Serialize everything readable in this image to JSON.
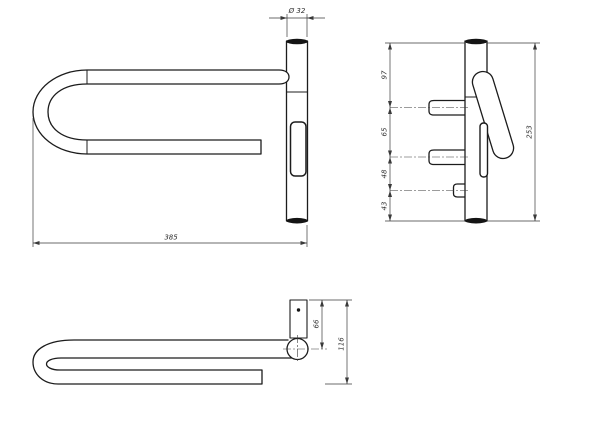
{
  "drawing": {
    "type": "technical-orthographic-drawing",
    "subject": "wall-mounted swing grab bar / towel rail",
    "views": {
      "front": {
        "label": "front-view",
        "dim_diameter": "Ø 32",
        "dim_length": "385"
      },
      "side": {
        "label": "side-view",
        "dim_seg_top": "97",
        "dim_seg_upper_mid": "65",
        "dim_seg_lower_mid": "48",
        "dim_seg_bottom": "43",
        "dim_overall_height": "253"
      },
      "top": {
        "label": "top-view",
        "dim_plate_to_center": "66",
        "dim_overall_depth": "116"
      }
    },
    "colors": {
      "background": "#ffffff",
      "object_line": "#1c1c1c",
      "dimension_line": "#3a3a3a"
    }
  }
}
